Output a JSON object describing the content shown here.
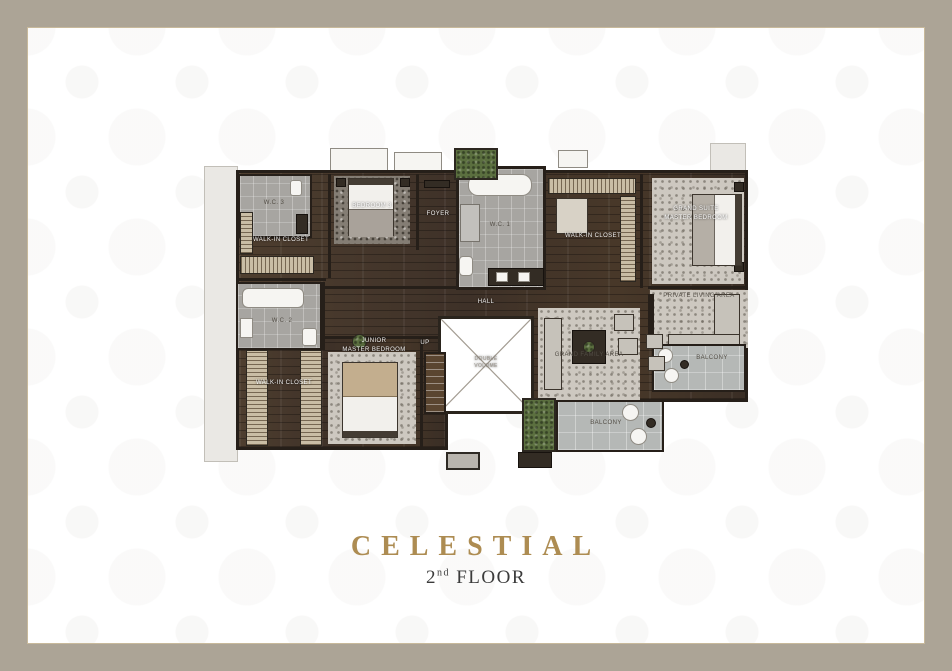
{
  "frame": {
    "border_color": "#aca496",
    "inner_line_color": "#c8b99b"
  },
  "title": {
    "name": "CELESTIAL",
    "floor_number": "2",
    "floor_ordinal": "nd",
    "floor_word": "FLOOR",
    "accent_color": "#ad8c52"
  },
  "plan": {
    "rooms": {
      "wc1": "W.C. 1",
      "wc2": "W.C. 2",
      "wc3": "W.C. 3",
      "walkin_closet_top": "WALK-IN CLOSET",
      "walkin_closet_right": "WALK-IN CLOSET",
      "walkin_closet_bottom": "WALK-IN CLOSET",
      "bedroom3": "BEDROOM 3",
      "foyer": "FOYER",
      "hall": "HALL",
      "grand_suite_line1": "GRAND SUITE",
      "grand_suite_line2": "MASTER BEDROOM",
      "junior_line1": "JUNIOR",
      "junior_line2": "MASTER BEDROOM",
      "private_living": "PRIVATE LIVING AREA",
      "family_area": "GRAND FAMILY AREA",
      "balcony_right": "BALCONY",
      "balcony_bottom": "BALCONY",
      "void_line1": "DOUBLE",
      "void_line2": "VOLUME",
      "up": "UP"
    }
  }
}
